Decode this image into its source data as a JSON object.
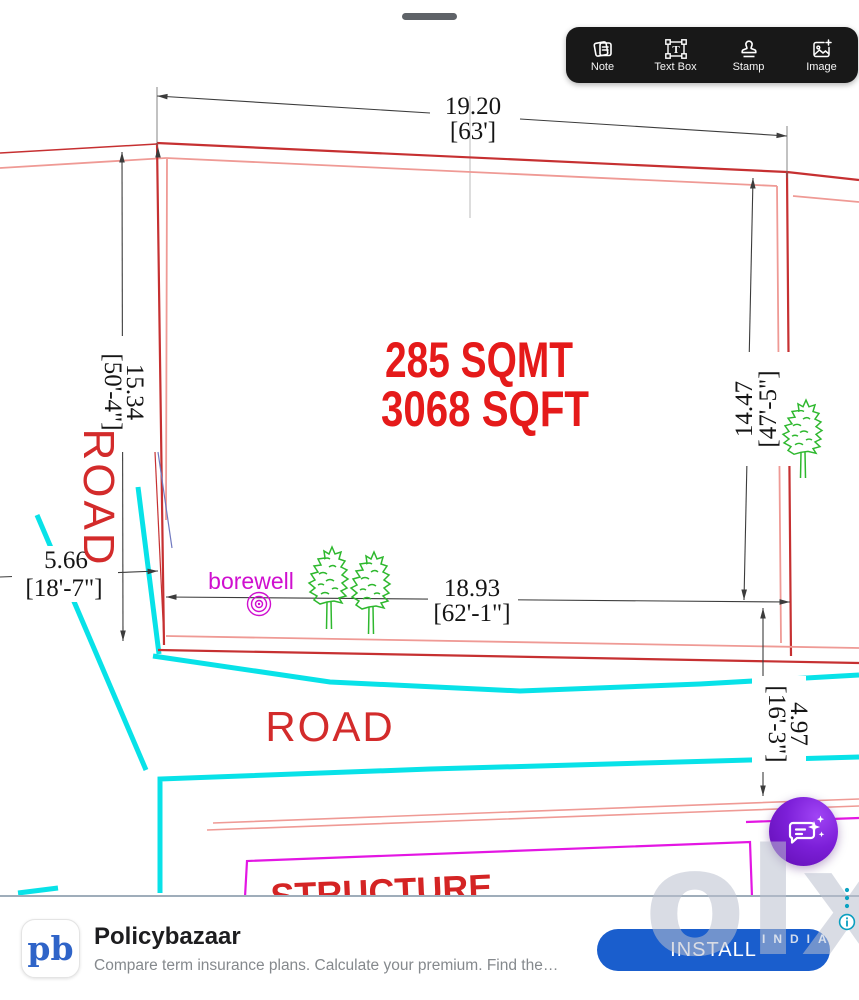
{
  "toolbar": {
    "items": [
      {
        "label": "Note",
        "icon": "note-icon"
      },
      {
        "label": "Text Box",
        "icon": "text-box-icon"
      },
      {
        "label": "Stamp",
        "icon": "stamp-icon"
      },
      {
        "label": "Image",
        "icon": "image-icon"
      }
    ]
  },
  "drawing": {
    "area_sqmt": "285 SQMT",
    "area_sqft": "3068 SQFT",
    "road_left_label": "ROAD",
    "road_bottom_label": "ROAD",
    "borewell_label": "borewell",
    "structure_label": "STRUCTURE",
    "dims": {
      "top_m": "19.20",
      "top_ft": "[63']",
      "left_m": "15.34",
      "left_ft": "[50'-4\"]",
      "right_m": "14.47",
      "right_ft": "[47'-5\"]",
      "bottom_m": "18.93",
      "bottom_ft": "[62'-1\"]",
      "left_lower_m": "5.66",
      "left_lower_ft": "[18'-7\"]",
      "right_lower_m": "4.97",
      "right_lower_ft": "[16'-3\"]"
    },
    "colors": {
      "boundary_red": "#c63031",
      "inner_salmon": "#ef9a95",
      "road_cyan": "#08e2e8",
      "structure_magenta": "#e316e3",
      "tree_green": "#2eb82e",
      "label_red": "#e51a1a",
      "borewell_magenta": "#cf0fcf"
    }
  },
  "watermark": {
    "logo": "olx",
    "country": "INDIA"
  },
  "banner": {
    "logo_text": "pb",
    "title": "Policybazaar",
    "description": "Compare term insurance plans. Calculate your premium. Find the…",
    "install_label": "INSTALL"
  }
}
